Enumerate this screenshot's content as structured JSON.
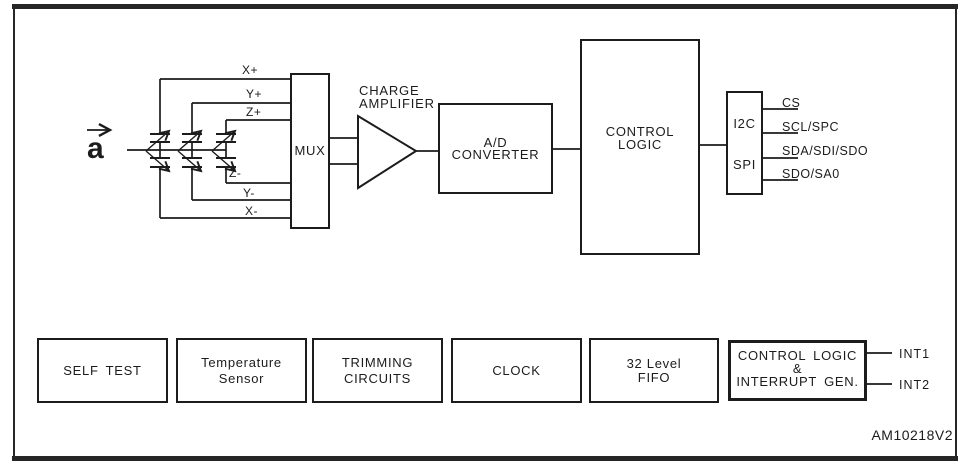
{
  "figure": {
    "code": "AM10218V2",
    "acceleration_symbol": "a"
  },
  "sensing_element": {
    "electrodes": [
      "X+",
      "Y+",
      "Z+",
      "Z-",
      "Y-",
      "X-"
    ]
  },
  "signal_chain": {
    "mux": "MUX",
    "charge_amplifier": [
      "CHARGE",
      "AMPLIFIER"
    ],
    "adc": [
      "A/D",
      "CONVERTER"
    ],
    "control_logic": [
      "CONTROL",
      "LOGIC"
    ],
    "serial_interface": [
      "I2C",
      "SPI"
    ],
    "output_pins": [
      "CS",
      "SCL/SPC",
      "SDA/SDI/SDO",
      "SDO/SA0"
    ]
  },
  "support_blocks": {
    "self_test": [
      "SELF TEST"
    ],
    "temperature_sensor": [
      "Temperature",
      "Sensor"
    ],
    "trimming_circuits": [
      "TRIMMING",
      "CIRCUITS"
    ],
    "clock": [
      "CLOCK"
    ],
    "fifo": [
      "32 Level",
      "FIFO"
    ],
    "interrupt_logic": [
      "CONTROL LOGIC",
      "&",
      "INTERRUPT GEN."
    ]
  },
  "interrupt_pins": [
    "INT1",
    "INT2"
  ],
  "colors": {
    "ink": "#1c1c1c",
    "background": "#ffffff"
  }
}
